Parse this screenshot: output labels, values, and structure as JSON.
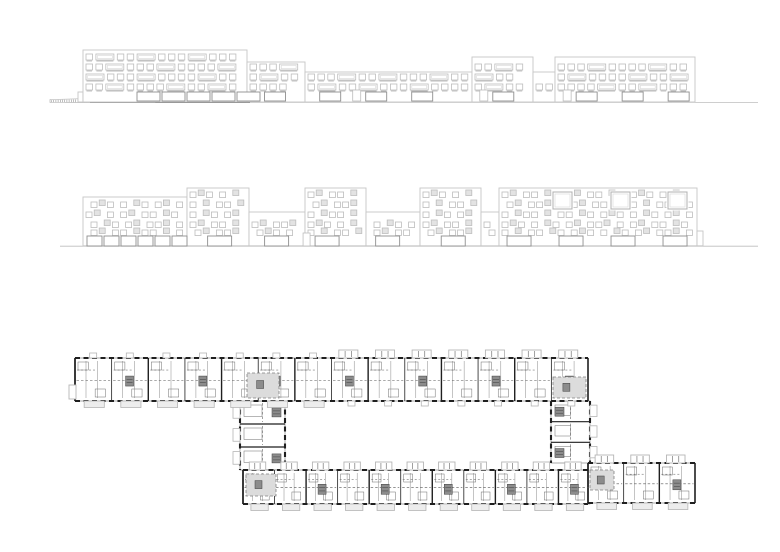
{
  "canvas": {
    "width": 780,
    "height": 552,
    "background": "#ffffff"
  },
  "figures": [
    {
      "name": "upper-elevation"
    },
    {
      "name": "lower-elevation"
    },
    {
      "name": "ground-floor-plan"
    }
  ],
  "colors": {
    "outline": "#c6c6c6",
    "window_stroke": "#bdbdbd",
    "window_inner": "#d8d8d8",
    "window_shadow": "#a5a5a5",
    "window_gray": "#e3e3e3",
    "big_opening_stroke": "#8f8f8f",
    "ground_thin": "#bdbdbd",
    "ground_mid": "#9e9e9e",
    "ground_dark": "#757575",
    "wall": "#1f1f1f",
    "wall_thin": "#707070",
    "partition": "#8a8a8a",
    "dash_line": "#555555",
    "balcony": "#b5b5b5",
    "balcony_fill": "#ededed",
    "room_shade": "#e0e0e0",
    "core_fill": "#8c8c8c",
    "core_line": "#3f3f3f",
    "junction_fill": "#dcdcdc",
    "junction_stroke": "#808080"
  },
  "elevation1": {
    "seed": 13,
    "ground_y": 102,
    "ground": {
      "x1": 65,
      "x2": 758
    },
    "dark_strip": {
      "x1": 90,
      "x2": 250,
      "y": 101,
      "h": 2
    },
    "mid_strip": {
      "x1": 250,
      "x2": 672,
      "y": 101.8
    },
    "ramp": {
      "x1": 50,
      "x2": 155,
      "y_left": 99.5,
      "y_right": 97,
      "base": 102.5,
      "tick_step": 2.2
    },
    "rows_y": [
      54,
      64,
      74,
      84
    ],
    "win_h": 6,
    "small_w": 6.5,
    "wide_w": 18,
    "gap": 3.4,
    "pattern": [
      "s",
      "s",
      "s",
      "s",
      "W",
      "s",
      "s",
      "W",
      "s",
      "s",
      "s",
      "W"
    ],
    "sections": [
      {
        "x": 78,
        "w": 5,
        "roof": 92,
        "norows": true
      },
      {
        "x": 83,
        "w": 164,
        "roof": 50,
        "cluster": true
      },
      {
        "x": 247,
        "w": 58,
        "roof": 62
      },
      {
        "x": 305,
        "w": 167,
        "roof": 72
      },
      {
        "x": 472,
        "w": 61,
        "roof": 57
      },
      {
        "x": 533,
        "w": 22,
        "roof": 72
      },
      {
        "x": 555,
        "w": 140,
        "roof": 57
      }
    ],
    "ground_cluster": {
      "x": 137,
      "count": 5,
      "w": 23,
      "gap": 2,
      "y": 92,
      "h": 9
    },
    "ground_row": {
      "y": 92,
      "h": 9,
      "w": 21,
      "pitch": 46,
      "door_w": 8,
      "door_h": 11
    }
  },
  "elevation2": {
    "seed": 29,
    "ground_y": 245.8,
    "ground": {
      "x1": 60,
      "x2": 758
    },
    "mid_strip": {
      "x1": 83,
      "x2": 700,
      "y": 244.9
    },
    "rows_y": [
      192,
      202,
      212,
      222,
      230
    ],
    "win_h": 5.5,
    "small_w": 6,
    "gap": 2.2,
    "skip": 5,
    "pattern": [
      "s",
      "s",
      "g",
      "s",
      "s",
      "s",
      "g",
      "s",
      "g",
      "s",
      "s",
      "g"
    ],
    "sections": [
      {
        "x": 83,
        "w": 104,
        "roof": 197,
        "cluster": true
      },
      {
        "x": 187,
        "w": 62,
        "roof": 188
      },
      {
        "x": 249,
        "w": 56,
        "roof": 212
      },
      {
        "x": 305,
        "w": 61,
        "roof": 188
      },
      {
        "x": 366,
        "w": 54,
        "roof": 212
      },
      {
        "x": 420,
        "w": 61,
        "roof": 188
      },
      {
        "x": 481,
        "w": 18,
        "roof": 212
      },
      {
        "x": 499,
        "w": 198,
        "roof": 188,
        "big_windows": [
          553,
          611,
          668
        ]
      },
      {
        "x": 697,
        "w": 6,
        "roof": 231,
        "norows": true
      }
    ],
    "big_window": {
      "y": 192,
      "w": 19,
      "h": 17
    },
    "ground_cluster": {
      "x": 87,
      "count": 6,
      "w": 15,
      "gap": 2,
      "y": 236,
      "h": 10
    },
    "ground_row": {
      "y": 236,
      "h": 10,
      "w": 24,
      "pitch": 52,
      "door_w": 7,
      "door_h": 13
    }
  },
  "plan": {
    "bars": [
      {
        "name": "top-bar",
        "x": 75,
        "y": 358,
        "w": 513,
        "h": 43,
        "modules": 14,
        "shaded_until": 300,
        "top_wide_from": 300,
        "bottom_balcony_until": 300,
        "core_offset": 1
      },
      {
        "name": "bottom-bar",
        "x": 243,
        "y": 470,
        "w": 347,
        "h": 34,
        "modules": 11,
        "shaded_until": 0,
        "top_wide_from": 0,
        "bottom_balcony_until": 590,
        "core_offset": 0
      },
      {
        "name": "right-arm",
        "x": 588,
        "y": 463,
        "w": 107,
        "h": 40,
        "modules": 3,
        "shaded_until": 0,
        "top_wide_from": 0,
        "bottom_balcony_until": 695,
        "core_offset": 0
      }
    ],
    "wings": [
      {
        "name": "left-wing",
        "x": 240,
        "y": 401,
        "w": 45,
        "h": 69,
        "rooms": 3,
        "balcony": "left"
      },
      {
        "name": "right-wing",
        "x": 551,
        "y": 401,
        "w": 39,
        "h": 62,
        "rooms": 3,
        "balcony": "right"
      }
    ],
    "junctions": [
      {
        "x": 247,
        "y": 373,
        "w": 32,
        "h": 25
      },
      {
        "x": 553,
        "y": 377,
        "w": 33,
        "h": 21
      },
      {
        "x": 246,
        "y": 474,
        "w": 30,
        "h": 22
      },
      {
        "x": 590,
        "y": 470,
        "w": 24,
        "h": 20
      }
    ],
    "module": {
      "balcony_h": 8,
      "bump_w": 7,
      "bump_h": 5,
      "core_w": 8,
      "core_h": 10
    },
    "end_cap": {
      "x": 69,
      "y": 385,
      "w": 7,
      "h": 14
    }
  }
}
